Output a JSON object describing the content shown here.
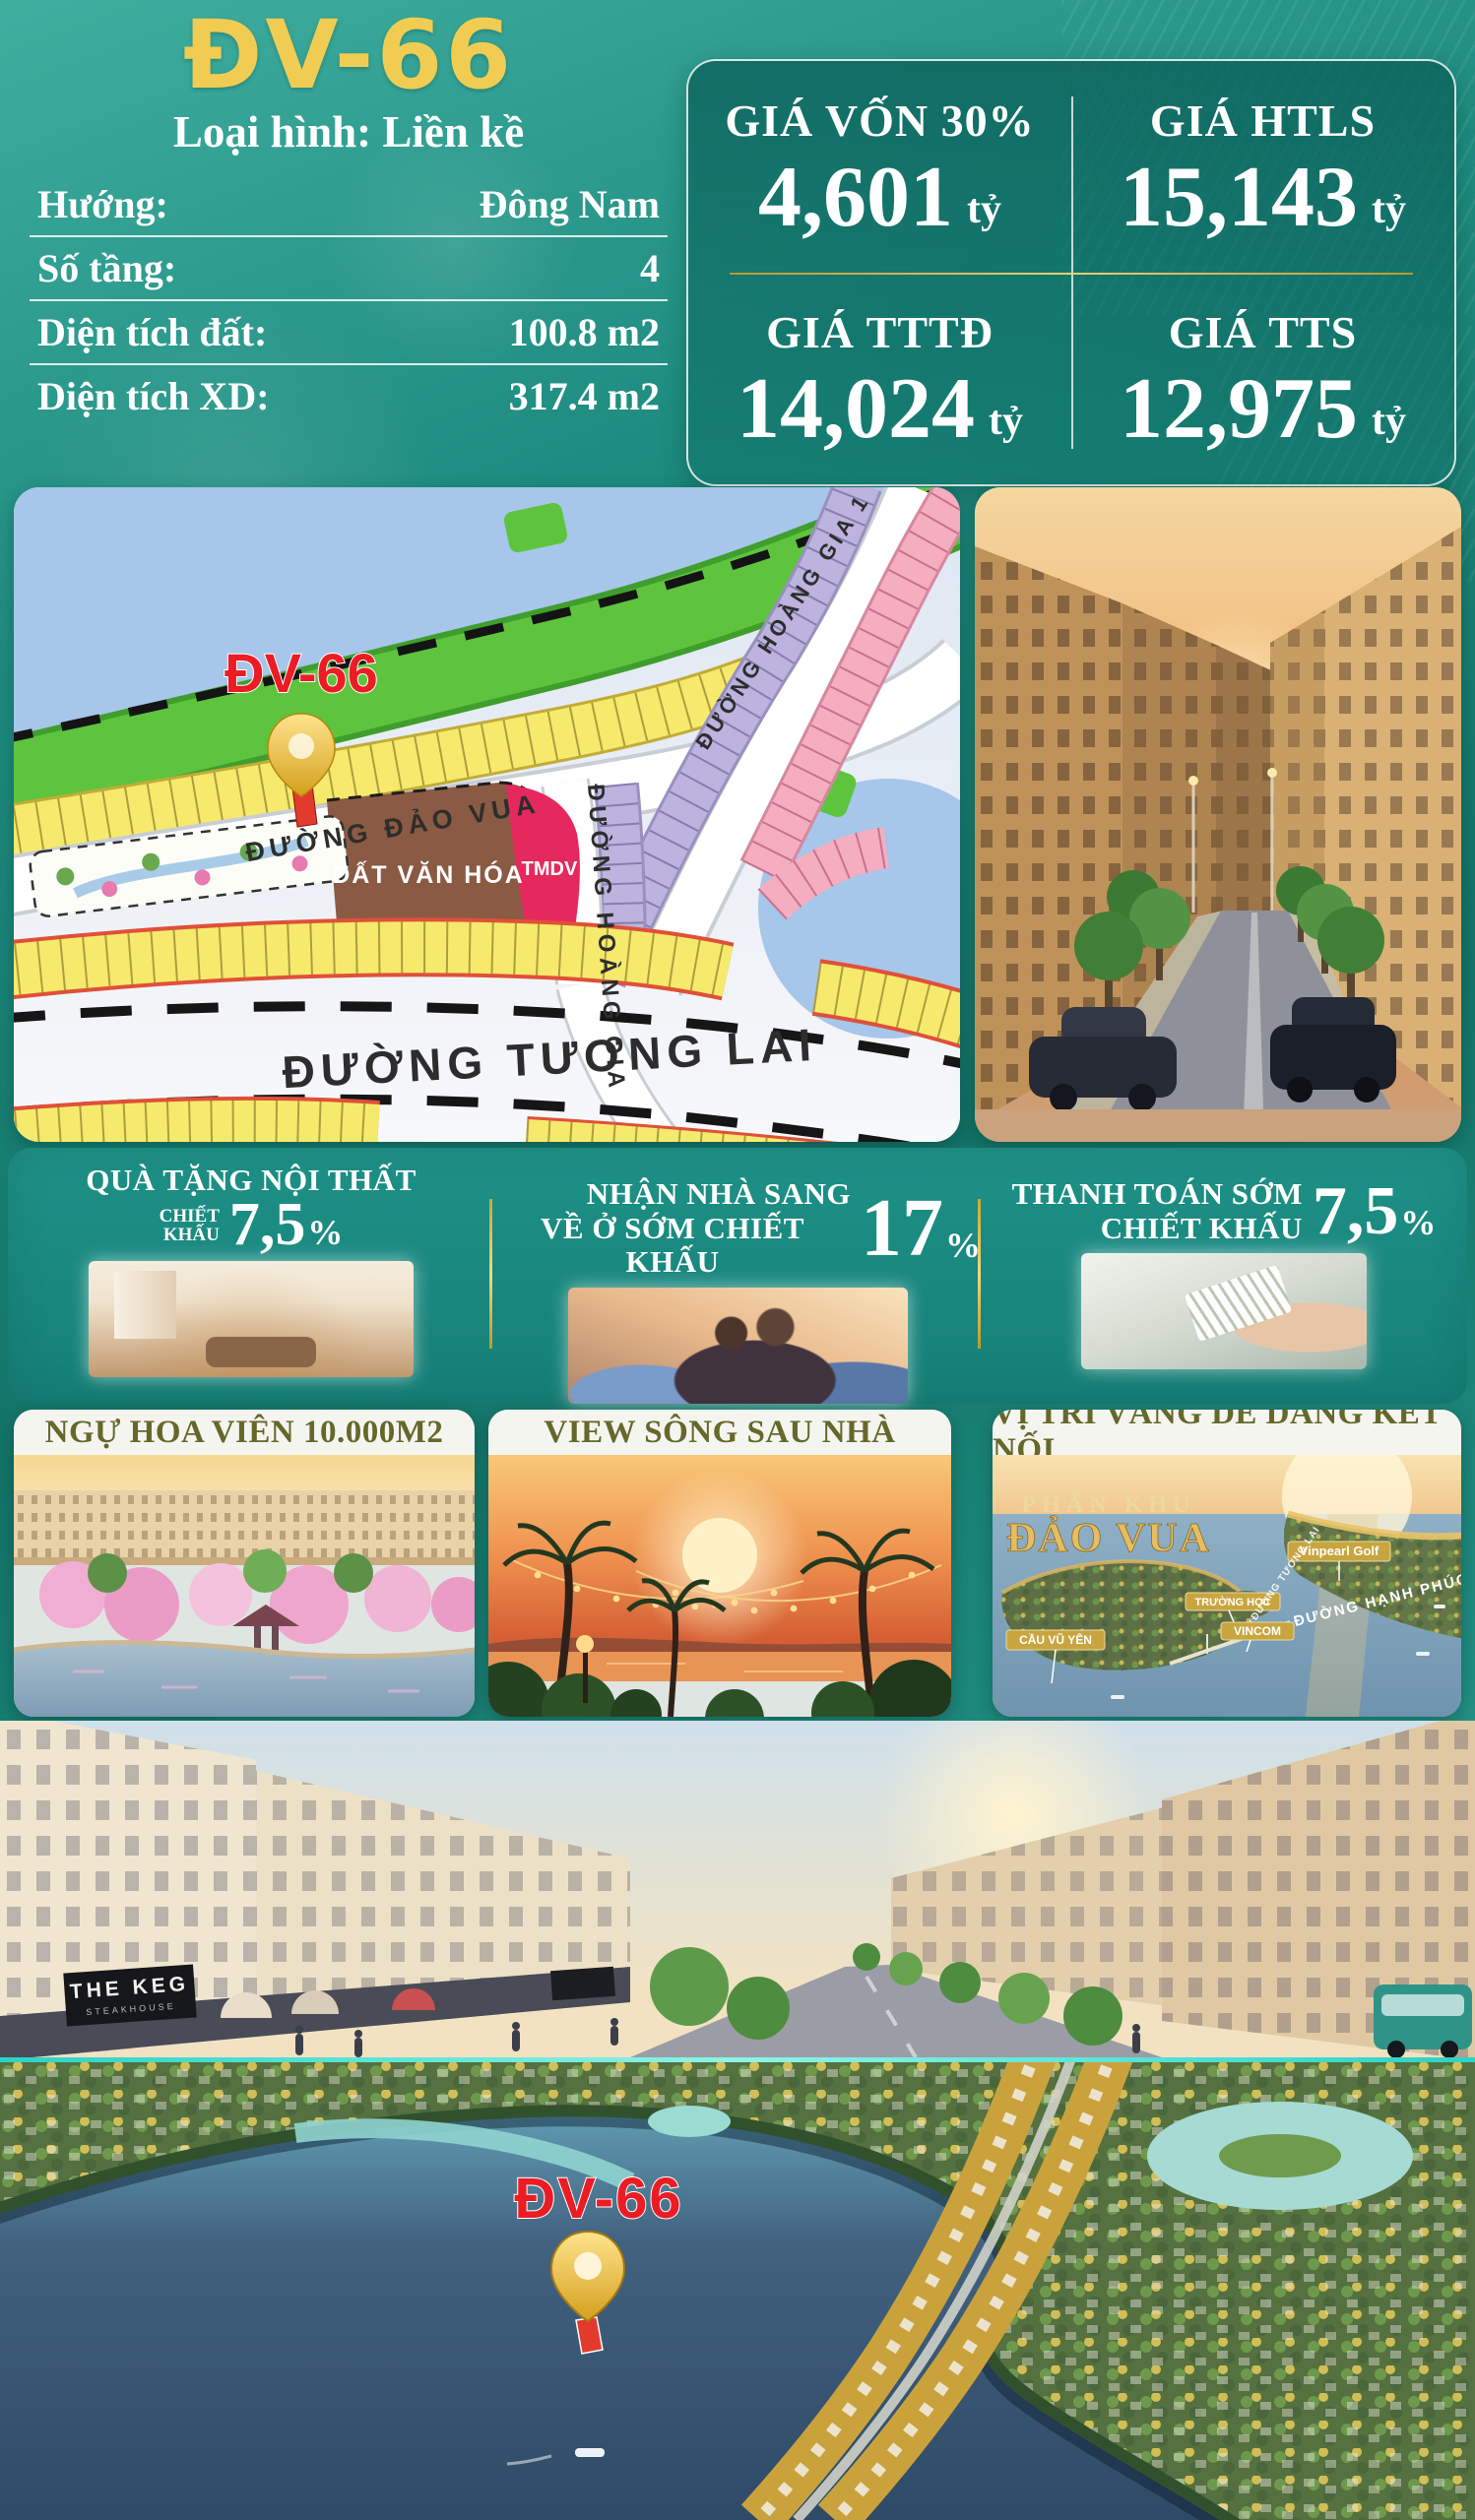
{
  "header": {
    "title": "ĐV-66",
    "subtitle": "Loại hình: Liền kề",
    "specs": [
      {
        "label": "Hướng:",
        "value": "Đông Nam"
      },
      {
        "label": "Số tầng:",
        "value": "4"
      },
      {
        "label": "Diện tích đất:",
        "value": "100.8 m2"
      },
      {
        "label": "Diện tích XD:",
        "value": "317.4 m2"
      }
    ]
  },
  "prices": [
    {
      "label": "GIÁ VỐN 30%",
      "value": "4,601",
      "unit": "tỷ"
    },
    {
      "label": "GIÁ HTLS",
      "value": "15,143",
      "unit": "tỷ"
    },
    {
      "label": "GIÁ TTTĐ",
      "value": "14,024",
      "unit": "tỷ"
    },
    {
      "label": "GIÁ TTS",
      "value": "12,975",
      "unit": "tỷ"
    }
  ],
  "map": {
    "marker_label": "ĐV-66",
    "street_dao_vua": "ĐƯỜNG ĐẢO VUA",
    "street_hoang_gia": "ĐƯỜNG HOÀNG GIA",
    "street_hoang_gia_1": "ĐƯỜNG HOÀNG GIA 1",
    "street_tuong_lai": "ĐƯỜNG TƯƠNG LAI",
    "zone_culture": "ĐẤT VĂN HÓA",
    "zone_commercial": "TMDV"
  },
  "promos": [
    {
      "title": "QUÀ TẶNG NỘI THẤT",
      "prefix_line1": "CHIẾT",
      "prefix_line2": "KHẤU",
      "percent": "7,5",
      "symbol": "%"
    },
    {
      "line1": "NHẬN NHÀ SANG",
      "line2": "VỀ Ở SỚM CHIẾT KHẤU",
      "percent": "17",
      "symbol": "%"
    },
    {
      "line1": "THANH TOÁN SỚM",
      "line2": "CHIẾT KHẤU",
      "percent": "7,5",
      "symbol": "%"
    }
  ],
  "cards": [
    {
      "title": "NGỰ HOA VIÊN 10.000M2"
    },
    {
      "title": "VIEW SÔNG SAU NHÀ"
    },
    {
      "title": "VỊ TRÍ VÀNG DỄ DÀNG KẾT NỐI",
      "labels": {
        "area_line1": "PHÂN KHU",
        "area_line2": "ĐẢO VUA",
        "golf": "Vinpearl Golf",
        "school": "TRƯỜNG HỌC",
        "mall": "VINCOM",
        "bridge": "CẦU VŨ YÊN",
        "road_happy": "ĐƯỜNG HẠNH PHÚC",
        "road_future": "ĐƯỜNG TƯƠNG LAI"
      }
    }
  ],
  "street_scene": {
    "sign_line1": "THE KEG",
    "sign_line2": "STEAKHOUSE"
  },
  "aerial": {
    "marker_label": "ĐV-66"
  },
  "colors": {
    "teal": "#17837a",
    "gold": "#ecc94f",
    "red": "#e8231d",
    "yellow_lot": "#f6ea6d",
    "white": "#ffffff"
  }
}
